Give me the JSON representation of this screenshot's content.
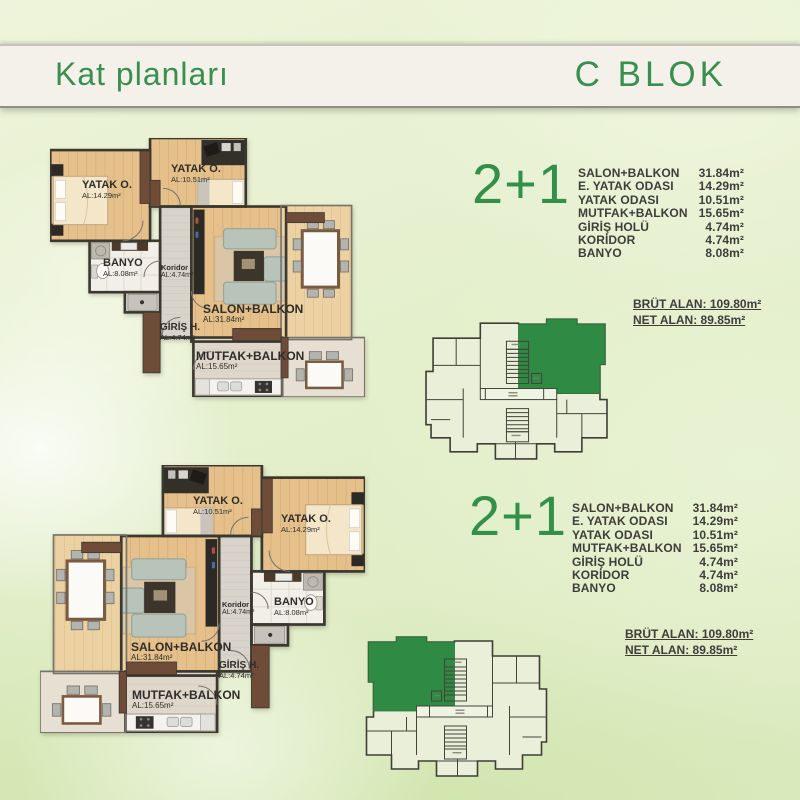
{
  "header": {
    "title": "Kat planları",
    "block": "C BLOK"
  },
  "colors": {
    "accent_green": "#33904a",
    "highlight_green": "#2f8a43",
    "text_dark": "#3e3d3a",
    "header_bg": "#f3f1ea"
  },
  "units": [
    {
      "type_label": "2+1",
      "rooms": [
        {
          "name": "SALON+BALKON",
          "area": "31.84m²"
        },
        {
          "name": "E. YATAK ODASI",
          "area": "14.29m²"
        },
        {
          "name": "YATAK ODASI",
          "area": "10.51m²"
        },
        {
          "name": "MUTFAK+BALKON",
          "area": "15.65m²"
        },
        {
          "name": "GİRİŞ HOLÜ",
          "area": "4.74m²"
        },
        {
          "name": "KORİDOR",
          "area": "4.74m²"
        },
        {
          "name": "BANYO",
          "area": "8.08m²"
        }
      ],
      "brut_alan": "BRÜT ALAN: 109.80m²",
      "net_alan": "NET ALAN: 89.85m²",
      "plan_labels": {
        "yatak1": {
          "name": "YATAK O.",
          "area": "AL:14.29m²"
        },
        "yatak2": {
          "name": "YATAK O.",
          "area": "AL:10.51m²"
        },
        "banyo": {
          "name": "BANYO",
          "area": "AL:8.08m²"
        },
        "koridor": {
          "name": "Koridor",
          "area": "AL:4.74m²"
        },
        "salon": {
          "name": "SALON+BALKON",
          "area": "AL:31.84m²"
        },
        "giris": {
          "name": "GİRİŞ H.",
          "area": "AL:4.74m²"
        },
        "mutfak": {
          "name": "MUTFAK+BALKON",
          "area": "AL:15.65m²"
        }
      },
      "key_plan_highlight": "top-right"
    },
    {
      "type_label": "2+1",
      "rooms": [
        {
          "name": "SALON+BALKON",
          "area": "31.84m²"
        },
        {
          "name": "E. YATAK ODASI",
          "area": "14.29m²"
        },
        {
          "name": "YATAK ODASI",
          "area": "10.51m²"
        },
        {
          "name": "MUTFAK+BALKON",
          "area": "15.65m²"
        },
        {
          "name": "GİRİŞ HOLÜ",
          "area": "4.74m²"
        },
        {
          "name": "KORİDOR",
          "area": "4.74m²"
        },
        {
          "name": "BANYO",
          "area": "8.08m²"
        }
      ],
      "brut_alan": "BRÜT ALAN: 109.80m²",
      "net_alan": "NET ALAN: 89.85m²",
      "plan_labels": {
        "yatak1": {
          "name": "YATAK O.",
          "area": "AL:14.29m²"
        },
        "yatak2": {
          "name": "YATAK O.",
          "area": "AL:10.51m²"
        },
        "banyo": {
          "name": "BANYO",
          "area": "AL:8.08m²"
        },
        "koridor": {
          "name": "Koridor",
          "area": "AL:4.74m²"
        },
        "salon": {
          "name": "SALON+BALKON",
          "area": "AL:31.84m²"
        },
        "giris": {
          "name": "GİRİŞ H.",
          "area": "AL:4.74m²"
        },
        "mutfak": {
          "name": "MUTFAK+BALKON",
          "area": "AL:15.65m²"
        }
      },
      "key_plan_highlight": "top-left"
    }
  ]
}
